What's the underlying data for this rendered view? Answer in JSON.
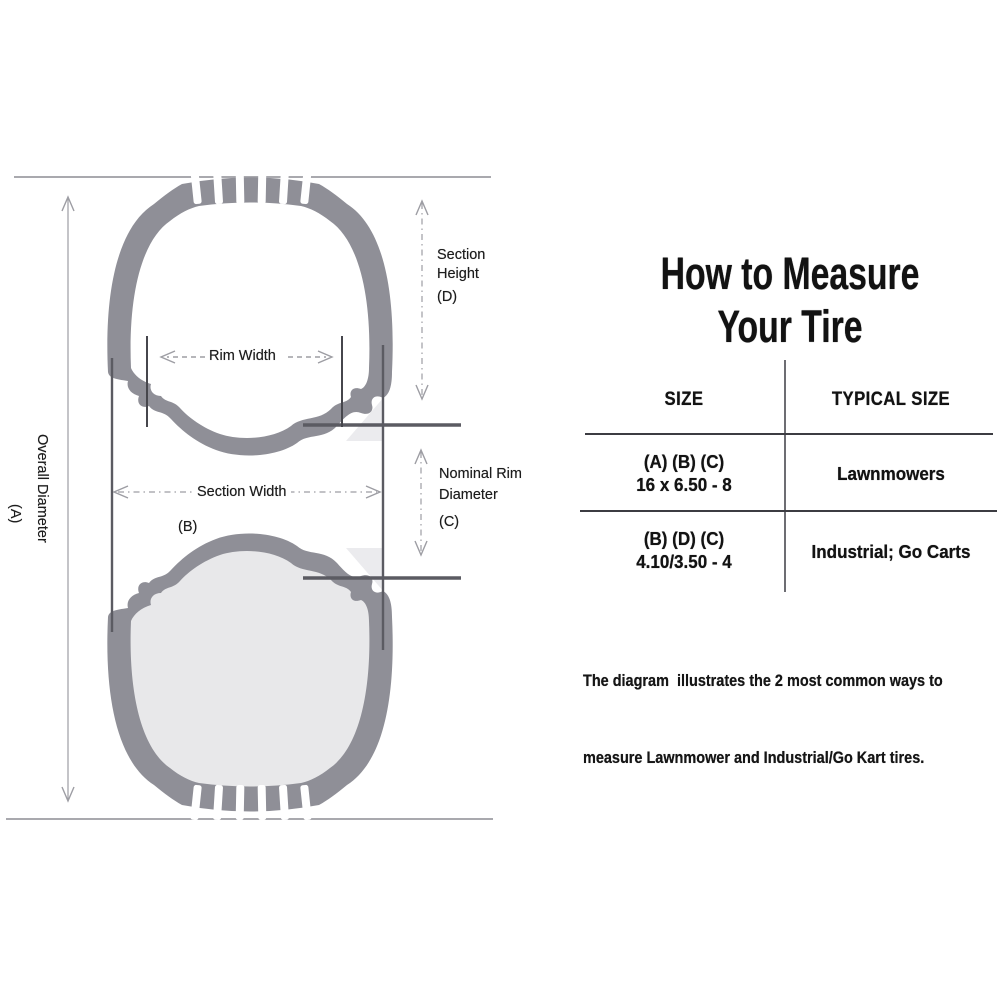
{
  "colors": {
    "tire": "#8f8f97",
    "inner_top": "#ffffff",
    "inner_bottom": "#e8e8ea",
    "measure": "#9d9da3",
    "dark_line": "#5b5b62",
    "tick": "#46464c",
    "text": "#1c1c1c"
  },
  "diagram": {
    "labels": {
      "overall_diameter": "Overall Diameter",
      "overall_diameter_key": "(A)",
      "section_height": [
        "Section",
        "Height",
        "(D)"
      ],
      "rim_width": "Rim Width",
      "section_width": "Section Width",
      "section_width_key": "(B)",
      "nominal_rim": [
        "Nominal Rim",
        "Diameter",
        "(C)"
      ]
    }
  },
  "panel": {
    "title": [
      "How to Measure",
      "Your Tire"
    ],
    "table": {
      "headers": [
        "SIZE",
        "TYPICAL SIZE"
      ],
      "rows": [
        {
          "size_keys": "(A) (B) (C)",
          "size_value": "16 x 6.50 - 8",
          "typical": "Lawnmowers"
        },
        {
          "size_keys": "(B) (D) (C)",
          "size_value": "4.10/3.50 - 4",
          "typical": "Industrial; Go Carts"
        }
      ]
    },
    "footnote": [
      "The diagram  illustrates the 2 most common ways to",
      "measure Lawnmower and Industrial/Go Kart tires."
    ]
  }
}
